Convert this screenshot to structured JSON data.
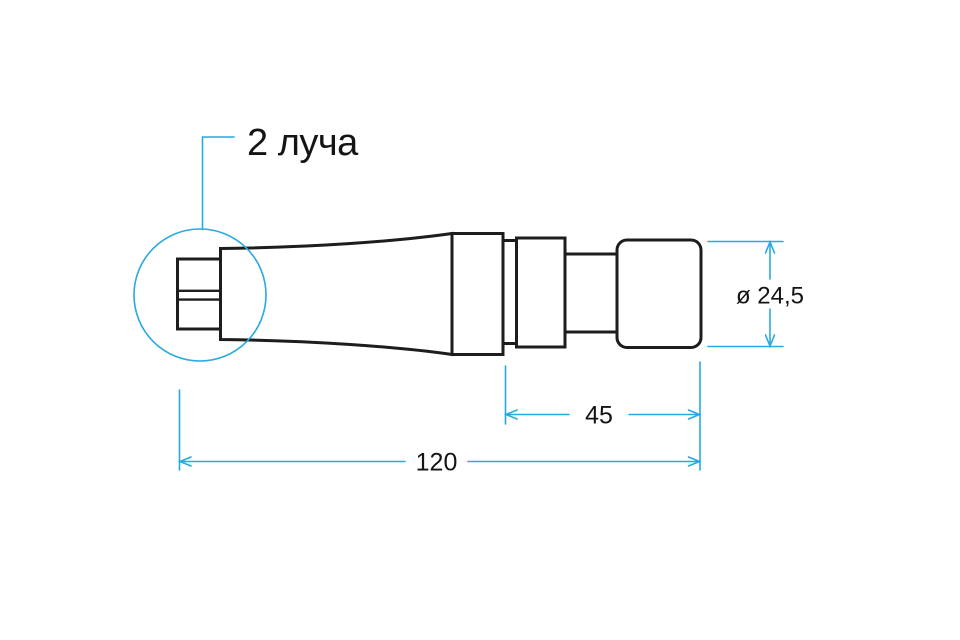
{
  "drawing": {
    "callout_label": "2 луча",
    "dimensions": {
      "diameter_label": "ø 24,5",
      "front_length_label": "45",
      "total_length_label": "120"
    },
    "colors": {
      "outline": "#1d1d1b",
      "dimension_blue": "#29a9e1",
      "text": "#141414",
      "background": "#ffffff"
    }
  }
}
